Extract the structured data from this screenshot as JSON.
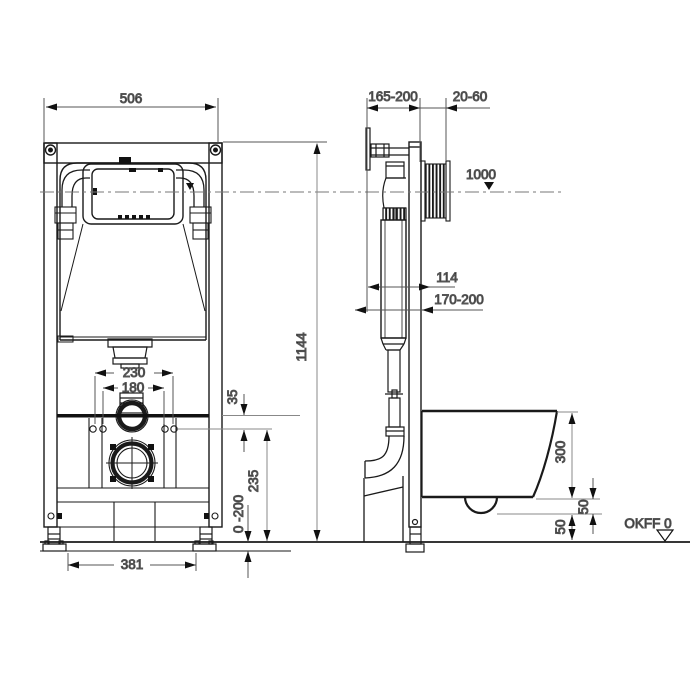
{
  "drawing": {
    "kind": "installation-frame-technical-drawing",
    "line_color": "#1a1a1a",
    "dim_color": "#555555",
    "background": "#ffffff"
  },
  "dims": {
    "frame_width": "506",
    "depth_range": "165-200",
    "plate_depth": "20-60",
    "actuation_height": "1000",
    "depth_114": "114",
    "depth_170_200": "170-200",
    "frame_height": "1144",
    "rods_outer": "230",
    "rods_inner": "180",
    "offset_35": "35",
    "outlet_height": "235",
    "foot_adjust": "0 -200",
    "feet_span": "381",
    "bowl_height": "300",
    "gap_upper": "50",
    "gap_lower": "50",
    "floor_datum": "OKFF 0"
  }
}
